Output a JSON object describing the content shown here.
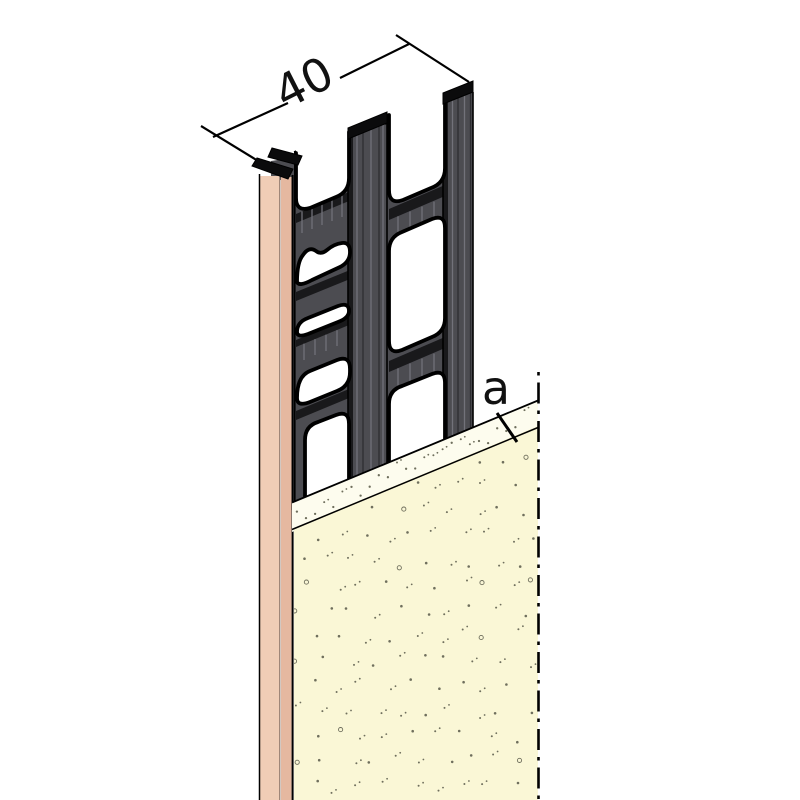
{
  "drawing": {
    "dimension_label": "40",
    "plaster_thickness_label": "a"
  },
  "colors": {
    "background": "#ffffff",
    "outline": "#000000",
    "web_face": "#4c4c51",
    "web_dark": "#19191b",
    "web_cap": "#0b0b0c",
    "streak_light": "#72727a",
    "streak_dark": "#2d2d31",
    "bead_face": "#f0cdb6",
    "bead_edge": "#e5b8a0",
    "bead_sep": "#8d7568",
    "plaster_face": "#faf7d6",
    "plaster_top": "#fdfcee",
    "speck": "#6f6f5d"
  }
}
